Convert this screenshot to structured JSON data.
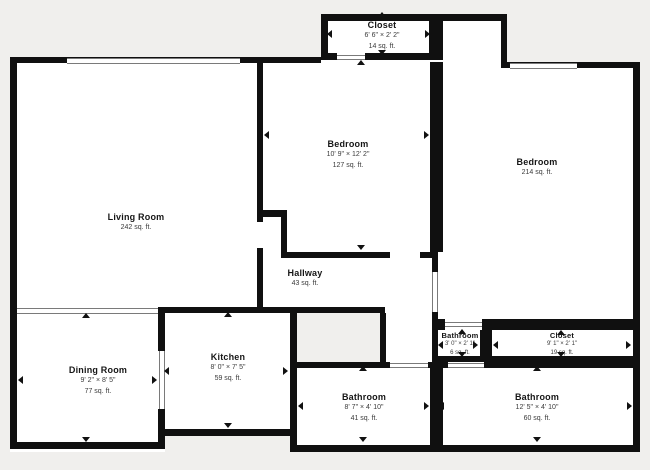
{
  "plan": {
    "background_color": "#f0efed",
    "wall_color": "#101010",
    "room_fill_color": "#ffffff",
    "window_line_color": "#7a7a7a"
  },
  "icons": {
    "dimension_arrow_up": "small black triangle marking top extent of measured room",
    "dimension_arrow_down": "small black triangle marking bottom extent of measured room",
    "dimension_arrow_left": "small black triangle marking left extent of measured room",
    "dimension_arrow_right": "small black triangle marking right extent of measured room"
  },
  "rooms": [
    {
      "name": "Closet",
      "dims": "6' 6\" × 2' 2\"",
      "area": "14 sq. ft."
    },
    {
      "name": "Bedroom",
      "dims": "10' 9\" × 12' 2\"",
      "area": "127 sq. ft."
    },
    {
      "name": "Bedroom",
      "dims": "",
      "area": "214 sq. ft."
    },
    {
      "name": "Living Room",
      "dims": "",
      "area": "242 sq. ft."
    },
    {
      "name": "Hallway",
      "dims": "",
      "area": "43 sq. ft."
    },
    {
      "name": "Dining Room",
      "dims": "9' 2\" × 8' 5\"",
      "area": "77 sq. ft."
    },
    {
      "name": "Kitchen",
      "dims": "8' 0\" × 7' 5\"",
      "area": "59 sq. ft."
    },
    {
      "name": "Bathroom",
      "dims": "3' 0\" × 2' 1\"",
      "area": "6 sq. ft."
    },
    {
      "name": "Closet",
      "dims": "9' 1\" × 2' 1\"",
      "area": "19 sq. ft."
    },
    {
      "name": "Bathroom",
      "dims": "8' 7\" × 4' 10\"",
      "area": "41 sq. ft."
    },
    {
      "name": "Bathroom",
      "dims": "12' 5\" × 4' 10\"",
      "area": "60 sq. ft."
    }
  ]
}
